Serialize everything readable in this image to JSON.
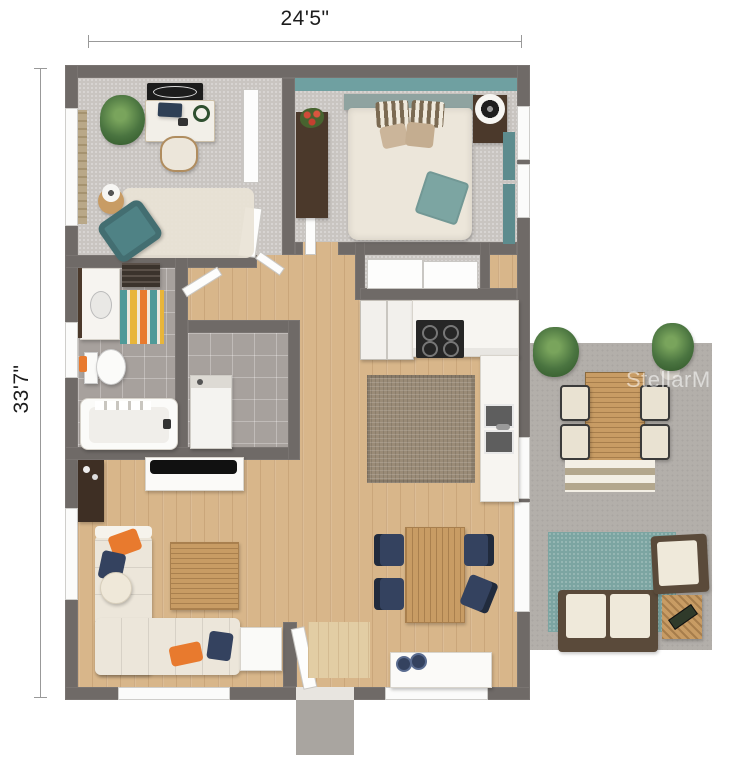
{
  "annotations": {
    "width_label": "24'5\"",
    "height_label": "33'7\"",
    "watermark": "StellarMLS"
  },
  "colors": {
    "wall": "#6f6a67",
    "carpet": "#c9c5c1",
    "tile": "#a7a19d",
    "wood": "#d8b68a",
    "patio": "#b3afaa",
    "teal": "#6fa0a1",
    "teal-dark": "#5d8c8e",
    "cream": "#ece6da",
    "navy": "#34425f",
    "orange": "#e87a2e",
    "dark-wood": "#4b392b",
    "oak": "#c89c64",
    "jute": "#9a8b77",
    "rug-teal": "#7ca5a2",
    "white": "#fbfbfa",
    "dim-line": "#999999",
    "text": "#1c1c1c"
  }
}
